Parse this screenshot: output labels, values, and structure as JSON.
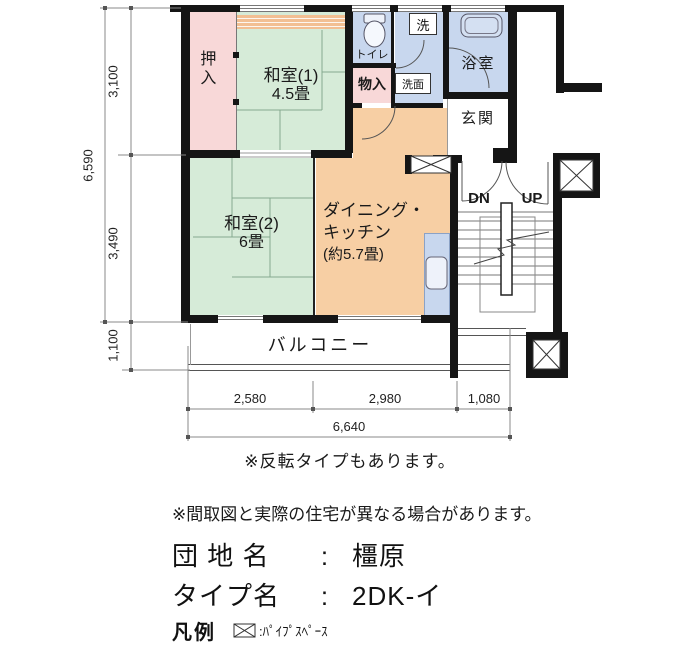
{
  "plan": {
    "rooms": {
      "oshiire": {
        "label": "押入"
      },
      "washitsu1": {
        "name": "和室(1)",
        "size": "4.5畳"
      },
      "washitsu2": {
        "name": "和室(2)",
        "size": "6畳"
      },
      "dining_kitchen": {
        "line1": "ダイニング・",
        "line2": "キッチン",
        "line3": "(約5.7畳)"
      },
      "toilet": {
        "label": "トイレ"
      },
      "laundry": {
        "label": "洗"
      },
      "washstand": {
        "label": "洗面"
      },
      "storage": {
        "label": "物入"
      },
      "bath": {
        "label": "浴室"
      },
      "entrance": {
        "label": "玄関"
      },
      "balcony": {
        "label": "バルコニー"
      },
      "stair_down": "DN",
      "stair_up": "UP"
    },
    "dimensions": {
      "left_top": "3,100",
      "left_total": "6,590",
      "left_middle": "3,490",
      "left_bottom": "1,100",
      "bottom_left": "2,580",
      "bottom_middle": "2,980",
      "bottom_right": "1,080",
      "bottom_total": "6,640"
    },
    "colors": {
      "tatami_green": "#d6ebd8",
      "closet_pink": "#f8d8d8",
      "wet_area_blue": "#c8d7ee",
      "dk_orange": "#f7cfa4",
      "wall_black": "#151515"
    }
  },
  "notes": {
    "note1": "※反転タイプもあります。",
    "note2": "※間取図と実際の住宅が異なる場合があります。"
  },
  "info": {
    "estate_label": "団 地 名",
    "estate_separator": ":",
    "estate_value": "橿原",
    "type_label": "タイプ名",
    "type_separator": ":",
    "type_value": "2DK-イ"
  },
  "legend": {
    "label": "凡例",
    "pipe_space": ":ﾊﾟｲﾌﾟｽﾍﾟｰｽ"
  }
}
